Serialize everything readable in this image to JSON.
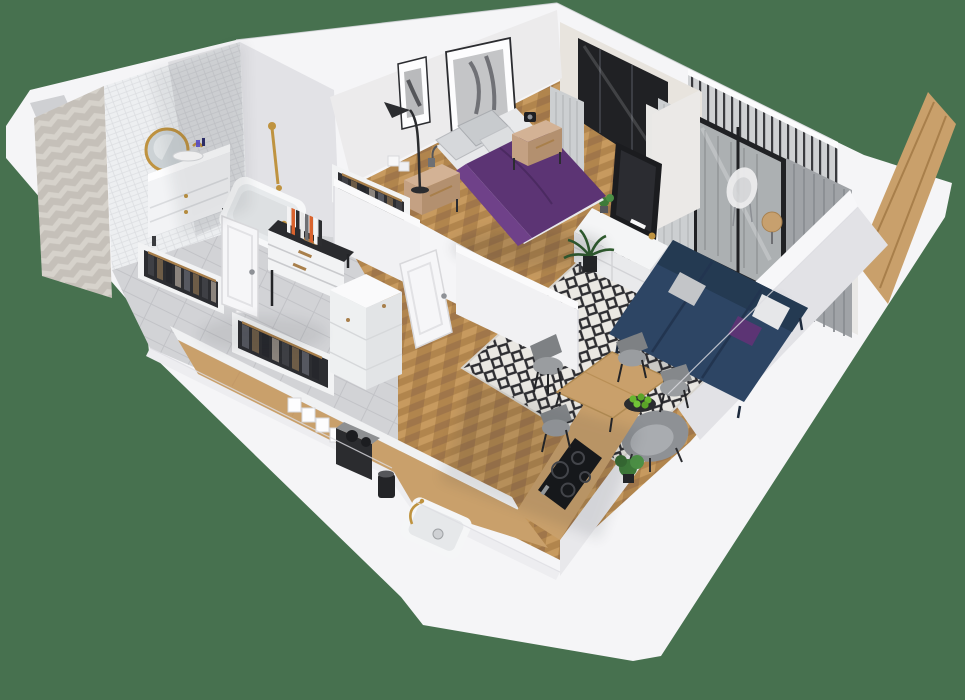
{
  "title": "3D isometric apartment floor plan render",
  "palette": {
    "bg": "#47714f",
    "shell": "#f5f5f7",
    "shellEdge": "#e7e7ea",
    "beigeWall": "#e8e4de",
    "wallFace": "#ecebec",
    "wallShadow": "#e2e2e6",
    "tileWall": "#edeff1",
    "chevronA": "#d6d2cb",
    "chevronB": "#c5c0b9",
    "grayFloor": "#d2d3d6",
    "woodFloor": "#b1854d",
    "woodLight": "#c79a5f",
    "woodDark": "#a0764a",
    "balconyFloor": "#b6b3ae",
    "railing": "#3a3b3f",
    "glass": "#c6c9cb",
    "curtainLight": "#cccfd1",
    "curtainDark": "#a0a3a7",
    "doorFrame": "#202124",
    "purple": "#5c3474",
    "purpleLight": "#6f4189",
    "navy": "#2d4564",
    "navyDark": "#243a52",
    "rugBase": "#eae8e3",
    "rugPattern": "#2d2d31",
    "offWhite": "#f1f2f3",
    "white": "#fafafb",
    "tv": "#1b1c1f",
    "gold": "#bf9340",
    "wood": "#c9a06b",
    "woodTrim": "#a87f4b",
    "grayFurniture": "#979a9e",
    "grayDark": "#595b60",
    "plant": "#3e7a39",
    "apple": "#66b52f",
    "black": "#26272b",
    "steel": "#9fa2a5"
  },
  "scene": {
    "view": "isometric cutaway, top-down 3D",
    "rooms": [
      {
        "name": "bathroom",
        "floor": "gray tile",
        "items": [
          "herringbone-tile-wall",
          "white-tile-wall",
          "round-gold-mirror",
          "vanity-with-sink",
          "gold-faucet",
          "bathtub",
          "gold-shower-set",
          "wall-niche"
        ]
      },
      {
        "name": "bedroom",
        "floor": "herringbone wood",
        "items": [
          "double-bed-purple-duvet",
          "gray-pillows",
          "nightstand-left",
          "nightstand-right",
          "alarm-clock",
          "arc-floor-lamp",
          "two-framed-pictures",
          "window-with-gray-curtains",
          "open-clothes-rack",
          "white-door"
        ]
      },
      {
        "name": "hallway",
        "floor": "gray tile",
        "items": [
          "open-wardrobe-1",
          "open-wardrobe-2",
          "chest-of-drawers",
          "books-row",
          "open-white-door"
        ]
      },
      {
        "name": "living-room",
        "floor": "herringbone wood",
        "items": [
          "navy-sofa",
          "throw-pillows",
          "diamond-pattern-rug",
          "round-coffee-table",
          "purple-vase",
          "tv-sideboard",
          "television",
          "palm-plant",
          "gray-armchair",
          "potted-plant"
        ]
      },
      {
        "name": "kitchen",
        "floor": "herringbone wood",
        "items": [
          "l-shaped-wood-counter",
          "white-cabinet-column",
          "induction-cooktop",
          "white-sink-gold-faucet",
          "coffee-machine",
          "grinder",
          "canister-set",
          "dining-table",
          "four-gray-chairs",
          "bowl-of-green-apples"
        ]
      },
      {
        "name": "balcony",
        "floor": "gray decking",
        "items": [
          "metal-railing",
          "glass-door-black-frame",
          "white-hanging-chair",
          "small-wood-table",
          "wooden-door-panel"
        ]
      }
    ]
  }
}
